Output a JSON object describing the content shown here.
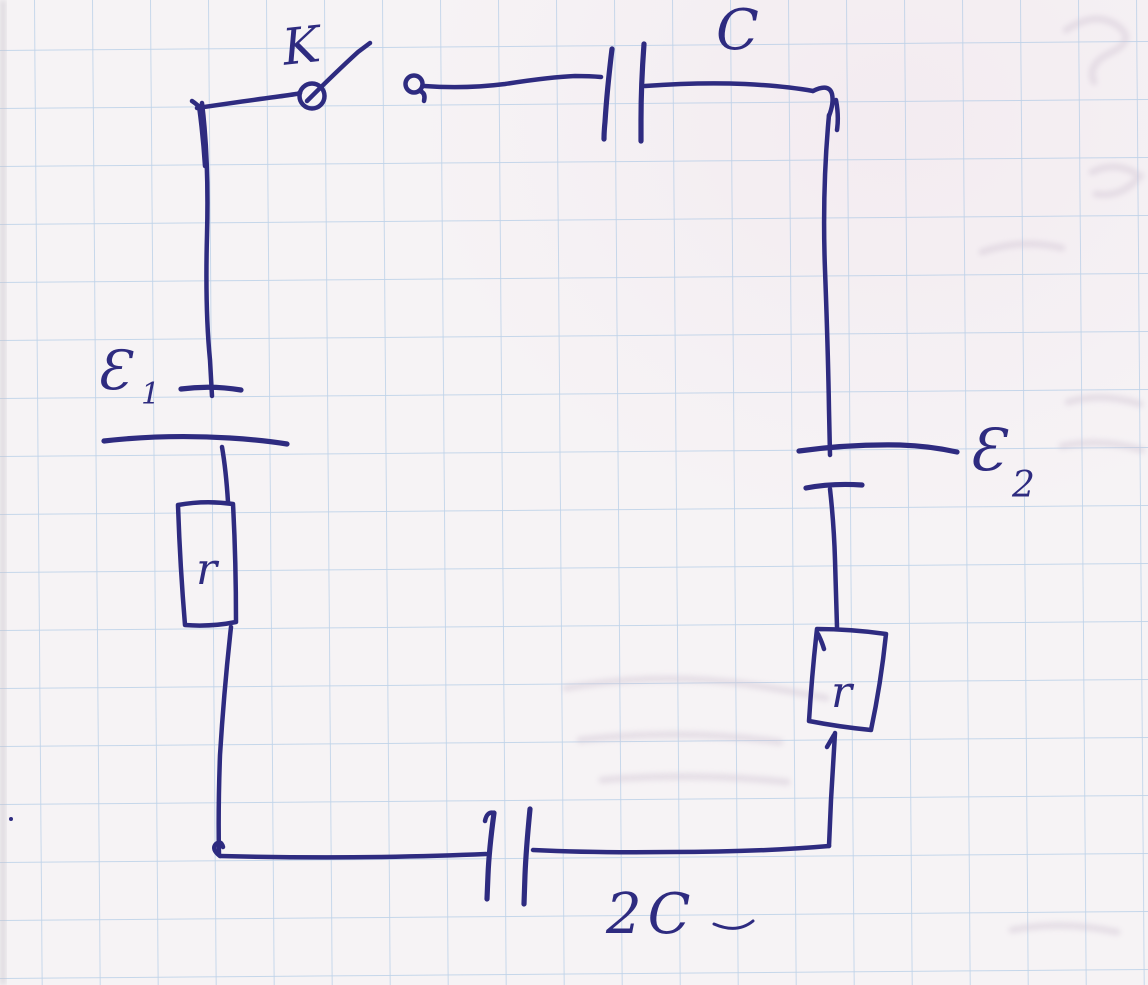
{
  "diagram": {
    "kind": "hand-drawn electrical circuit schematic on squared notebook paper",
    "colors": {
      "paper": "#f6f3f5",
      "grid": "#a9c6e4",
      "ink": "#2e2b80",
      "ghost": "#cfc2d2"
    },
    "labels": {
      "switch": "K",
      "top_capacitor": "C",
      "left_emf": "Ɛ",
      "left_emf_sub": "1",
      "right_emf": "Ɛ",
      "right_emf_sub": "2",
      "left_resistor": "r",
      "right_resistor": "r",
      "bottom_capacitor": "2C"
    },
    "components": [
      {
        "id": "K",
        "type": "switch, open",
        "position": "top-left"
      },
      {
        "id": "C",
        "type": "capacitor",
        "position": "top"
      },
      {
        "id": "E1",
        "type": "EMF source (battery)",
        "position": "left"
      },
      {
        "id": "r",
        "type": "resistor in box",
        "position": "left"
      },
      {
        "id": "E2",
        "type": "EMF source (battery)",
        "position": "right"
      },
      {
        "id": "r2",
        "type": "resistor in box",
        "position": "right"
      },
      {
        "id": "2C",
        "type": "capacitor",
        "position": "bottom"
      }
    ]
  }
}
